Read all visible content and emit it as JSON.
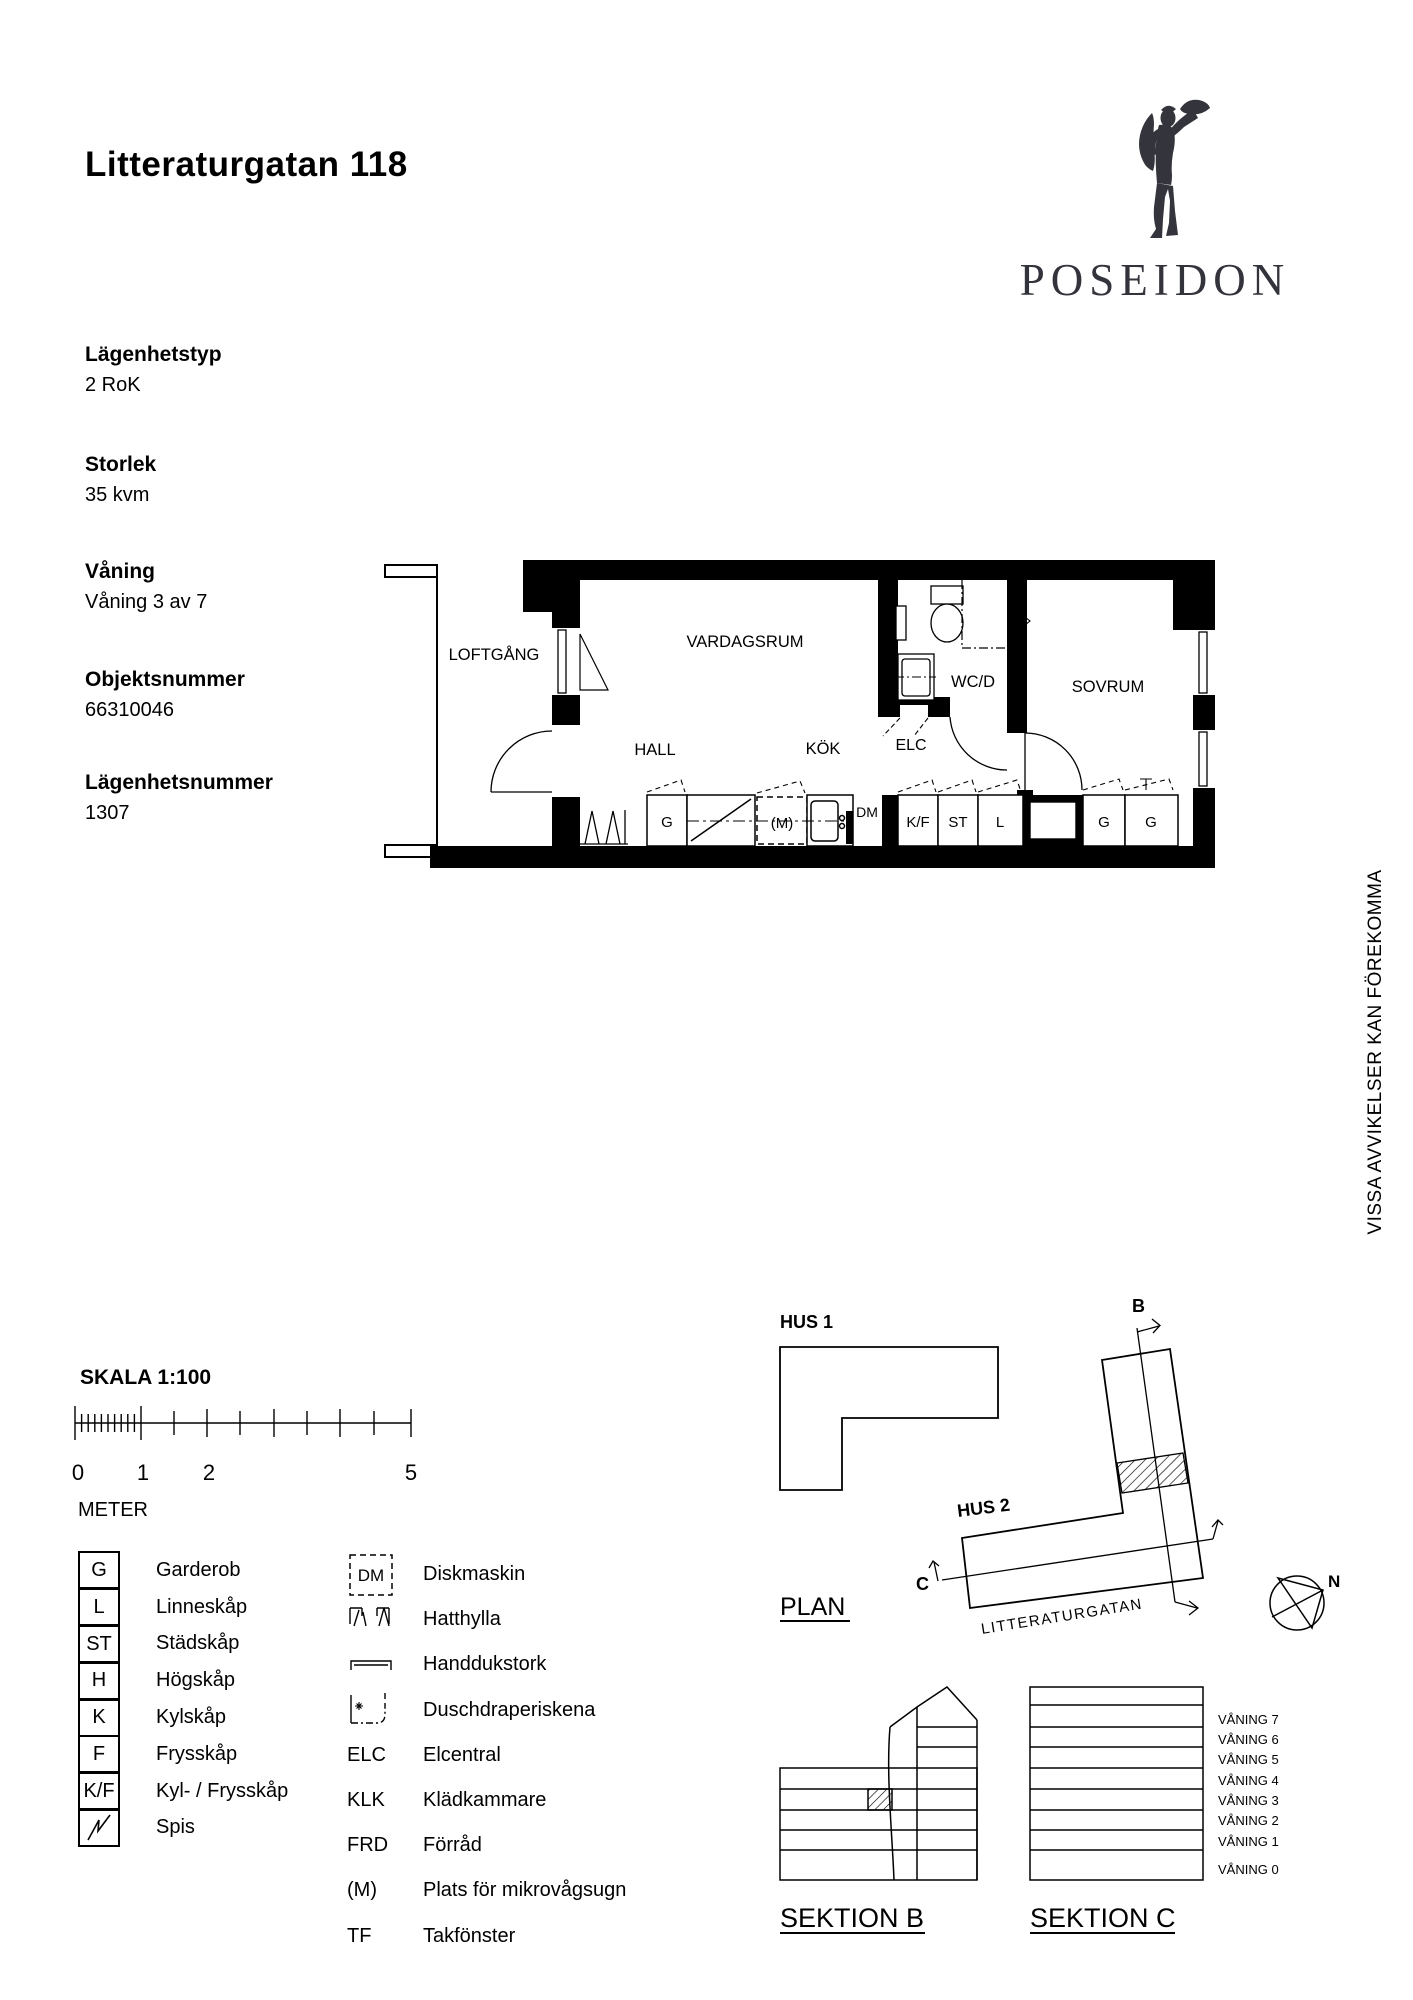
{
  "header": {
    "title": "Litteraturgatan 118",
    "logo_text": "POSEIDON"
  },
  "info": [
    {
      "label": "Lägenhetstyp",
      "value": "2 RoK"
    },
    {
      "label": "Storlek",
      "value": "35 kvm"
    },
    {
      "label": "Våning",
      "value": "Våning 3 av 7"
    },
    {
      "label": "Objektsnummer",
      "value": "66310046"
    },
    {
      "label": "Lägenhetsnummer",
      "value": "1307"
    }
  ],
  "floorplan": {
    "rooms": {
      "loftgang": "LOFTGÅNG",
      "vardagsrum": "VARDAGSRUM",
      "hall": "HALL",
      "kok": "KÖK",
      "wcd": "WC/D",
      "elc": "ELC",
      "sovrum": "SOVRUM"
    },
    "fixtures": {
      "g1": "G",
      "m": "(M)",
      "dm": "DM",
      "kf": "K/F",
      "st": "ST",
      "l": "L",
      "g2": "G",
      "g3": "G"
    }
  },
  "note_vertical": "VISSA AVVIKELSER KAN FÖREKOMMA",
  "scale": {
    "heading": "SKALA 1:100",
    "unit": "METER",
    "ticks": [
      "0",
      "1",
      "2",
      "5"
    ]
  },
  "legend_left": [
    {
      "key": "G",
      "label": "Garderob"
    },
    {
      "key": "L",
      "label": "Linneskåp"
    },
    {
      "key": "ST",
      "label": "Städskåp"
    },
    {
      "key": "H",
      "label": "Högskåp"
    },
    {
      "key": "K",
      "label": "Kylskåp"
    },
    {
      "key": "F",
      "label": "Frysskåp"
    },
    {
      "key": "K/F",
      "label": "Kyl- / Frysskåp"
    },
    {
      "key": "",
      "label": "Spis"
    }
  ],
  "legend_right": [
    {
      "key": "DM",
      "label": "Diskmaskin"
    },
    {
      "key": "",
      "label": "Hatthylla"
    },
    {
      "key": "",
      "label": "Handdukstork"
    },
    {
      "key": "",
      "label": "Duschdraperiskena"
    },
    {
      "key": "ELC",
      "label": "Elcentral"
    },
    {
      "key": "KLK",
      "label": "Klädkammare"
    },
    {
      "key": "FRD",
      "label": "Förråd"
    },
    {
      "key": "(M)",
      "label": "Plats för mikrovågsugn"
    },
    {
      "key": "TF",
      "label": "Takfönster"
    }
  ],
  "siteplan": {
    "hus1": "HUS 1",
    "hus2": "HUS 2",
    "plan": "PLAN",
    "street": "LITTERATURGATAN",
    "sec_b": "B",
    "sec_c": "C",
    "north": "N"
  },
  "sections": {
    "title_b": "SEKTION B",
    "title_c": "SEKTION C",
    "floors": [
      "VÅNING 7",
      "VÅNING 6",
      "VÅNING 5",
      "VÅNING 4",
      "VÅNING 3",
      "VÅNING 2",
      "VÅNING 1",
      "VÅNING 0"
    ]
  }
}
